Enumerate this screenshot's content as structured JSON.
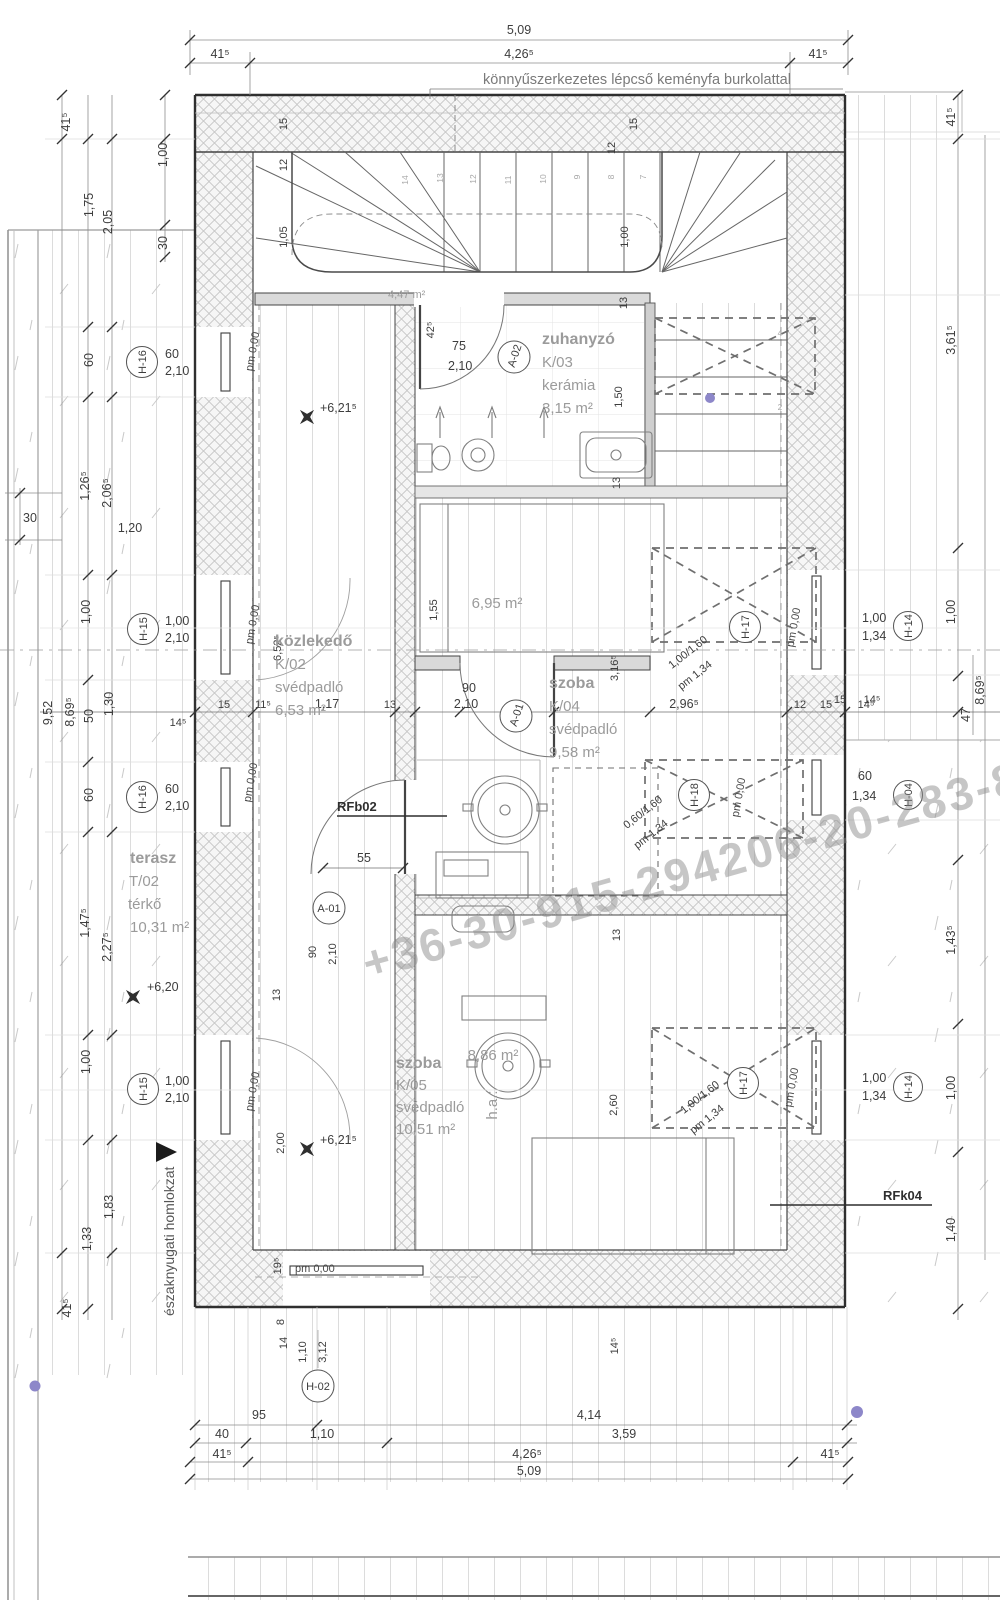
{
  "note": "könnyűszerkezetes lépcső keményfa burkolattal",
  "watermark": "+36-30-915-294206-20-283-8",
  "facade_label": "északnyugati homlokzat",
  "rooms": {
    "shower": {
      "name": "zuhanyzó",
      "code": "K/03",
      "floor": "kerámia",
      "area": "3,15 m²"
    },
    "corridor": {
      "name": "közlekedő",
      "code": "K/02",
      "floor": "svédpadló",
      "area": "6,53 m²"
    },
    "room1": {
      "name": "szoba",
      "code": "K/04",
      "floor": "svédpadló",
      "area": "9,58 m²",
      "sub_area": "6,95 m²"
    },
    "room2": {
      "name": "szoba",
      "code": "K/05",
      "floor": "svédpadló",
      "area": "10,51 m²",
      "sub_area": "8,86 m²"
    },
    "terrace": {
      "name": "terasz",
      "code": "T/02",
      "floor": "térkő",
      "area": "10,31 m²"
    },
    "adj_area": "4,47 m²"
  },
  "levels": {
    "l620": "+6,20",
    "l621a": "+6,21⁵",
    "l621b": "+6,21⁵",
    "pm0": "pm 0,00"
  },
  "tags": {
    "h16": {
      "id": "H-16",
      "w": "60",
      "h": "2,10"
    },
    "h15": {
      "id": "H-15",
      "w": "1,00",
      "h": "2,10"
    },
    "h17": {
      "id": "H-17",
      "size": "1,00/1,60",
      "sill": "pm 1,34"
    },
    "h18": {
      "id": "H-18",
      "size": "0,60/1,60",
      "sill": "pm 1,34"
    },
    "h14": {
      "id": "H-14",
      "w": "1,00",
      "h": "1,34"
    },
    "h04": {
      "id": "H-04",
      "w": "60",
      "h": "1,34"
    },
    "h02": {
      "id": "H-02",
      "w": "1,10",
      "h": "3,12"
    },
    "a01": {
      "id": "A-01",
      "w": "90",
      "h": "2,10"
    },
    "a02": {
      "id": "A-02",
      "w": "75",
      "h": "2,10"
    }
  },
  "refs": {
    "rfb02": "RFb02",
    "rfk04": "RFk04"
  },
  "dims": {
    "top": [
      "5,09",
      "41⁵",
      "4,26⁵",
      "41⁵"
    ],
    "left": [
      "41⁵",
      "1,00",
      "1,75",
      "2,05",
      "30",
      "60",
      "1,26⁵",
      "2,06⁵",
      "30",
      "1,20",
      "1,00",
      "9,52",
      "8,69⁵",
      "50",
      "1,30",
      "60",
      "1,47⁵",
      "2,27⁵",
      "1,00",
      "1,83",
      "1,33",
      "41⁵"
    ],
    "right": [
      "41⁵",
      "3,61⁵",
      "1,00",
      "1,43⁵",
      "1,00",
      "1,40",
      "47",
      "8,69⁵",
      "15",
      "14⁵"
    ],
    "middle": [
      "14⁵",
      "15",
      "11⁵",
      "1,17",
      "13",
      "2,96⁵",
      "12",
      "15",
      "14⁵"
    ],
    "stair": [
      "15",
      "12",
      "1,05",
      "15",
      "12",
      "1,00",
      "13"
    ],
    "bottom": [
      "19⁵",
      "8",
      "14",
      "95",
      "40",
      "41⁵",
      "1,10",
      "4,14",
      "3,59",
      "4,26⁵",
      "5,09",
      "41⁵",
      "14⁵"
    ],
    "inner": [
      "42⁵",
      "1,50",
      "1,55",
      "3,16⁵",
      "6,52⁵",
      "55",
      "13",
      "13",
      "13",
      "2,60",
      "2,00"
    ]
  },
  "steps": [
    "14",
    "13",
    "12",
    "11",
    "10",
    "9",
    "8",
    "7",
    "4",
    "2"
  ],
  "misc": {
    "ha": "h.a.:"
  }
}
